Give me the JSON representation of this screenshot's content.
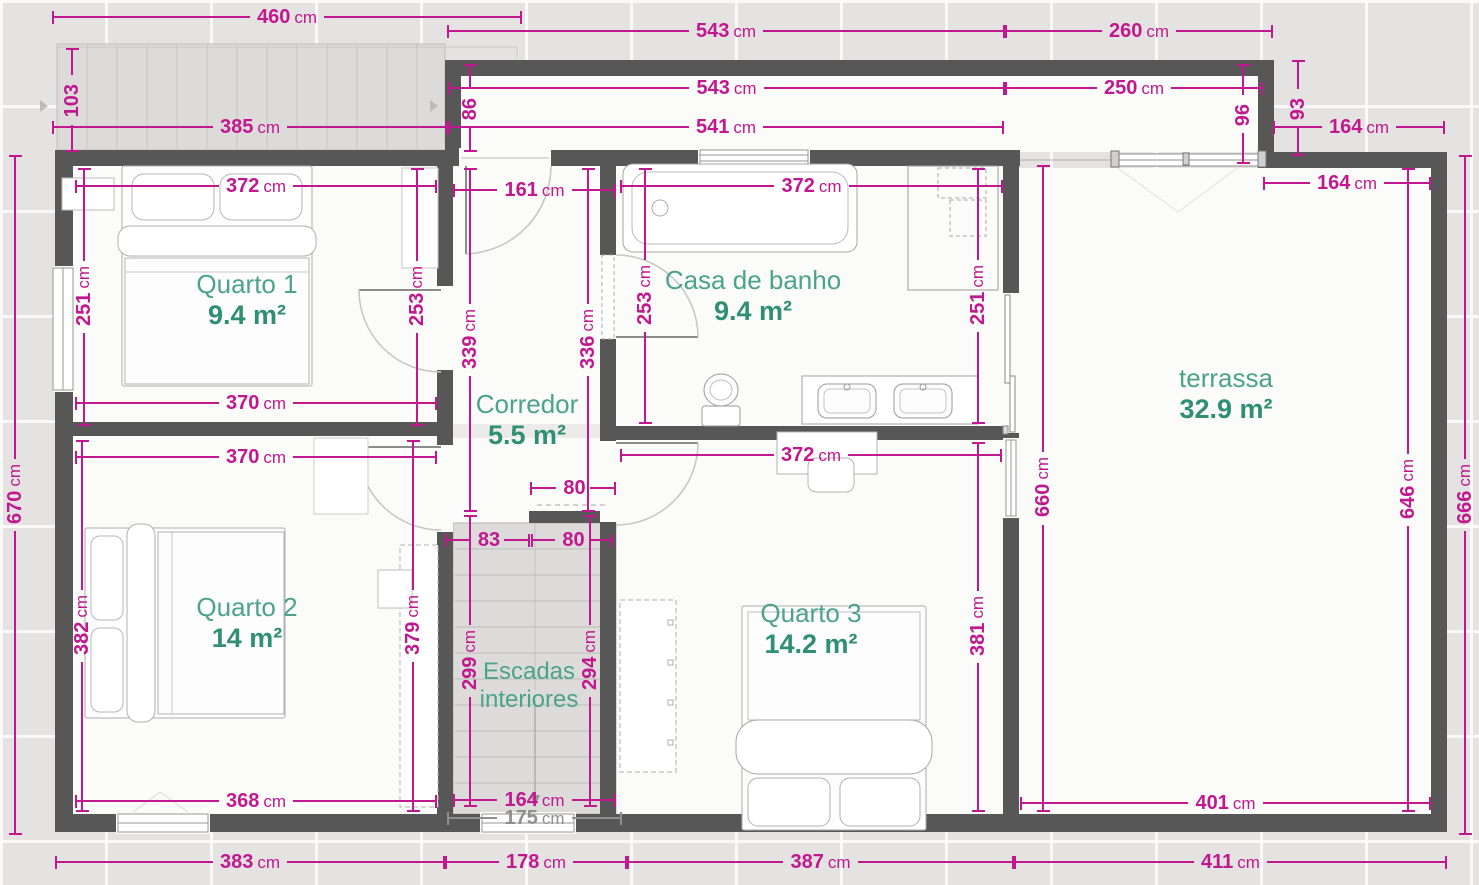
{
  "plan_type": "floor-plan",
  "language": "Portuguese",
  "colors": {
    "dimension": "#c2188f",
    "dimension_gray": "#8f8f8f",
    "room_label": "#4ba38a",
    "room_area": "#2f8f72",
    "wall": "#575757",
    "background": "#e4e3e2"
  },
  "rooms": [
    {
      "name": "Quarto 1",
      "area": "9.4 m²"
    },
    {
      "name": "Casa de banho",
      "area": "9.4 m²"
    },
    {
      "name": "Corredor",
      "area": "5.5 m²"
    },
    {
      "name": "Quarto 2",
      "area": "14 m²"
    },
    {
      "name": "Quarto 3",
      "area": "14.2 m²"
    },
    {
      "name": "Escadas",
      "name2": "interiores",
      "area": ""
    },
    {
      "name": "terrassa",
      "area": "32.9 m²"
    }
  ],
  "dims": [
    {
      "v": "460",
      "u": "cm"
    },
    {
      "v": "543",
      "u": "cm"
    },
    {
      "v": "260",
      "u": "cm"
    },
    {
      "v": "543",
      "u": "cm"
    },
    {
      "v": "250",
      "u": "cm"
    },
    {
      "v": "385",
      "u": "cm"
    },
    {
      "v": "541",
      "u": "cm"
    },
    {
      "v": "164",
      "u": "cm"
    },
    {
      "v": "164",
      "u": "cm"
    },
    {
      "v": "372",
      "u": "cm"
    },
    {
      "v": "161",
      "u": "cm"
    },
    {
      "v": "372",
      "u": "cm"
    },
    {
      "v": "370",
      "u": "cm"
    },
    {
      "v": "370",
      "u": "cm"
    },
    {
      "v": "372",
      "u": "cm"
    },
    {
      "v": "80",
      "u": ""
    },
    {
      "v": "83",
      "u": ""
    },
    {
      "v": "80",
      "u": ""
    },
    {
      "v": "368",
      "u": "cm"
    },
    {
      "v": "164",
      "u": "cm"
    },
    {
      "v": "175",
      "u": "cm"
    },
    {
      "v": "401",
      "u": "cm"
    },
    {
      "v": "383",
      "u": "cm"
    },
    {
      "v": "178",
      "u": "cm"
    },
    {
      "v": "387",
      "u": "cm"
    },
    {
      "v": "411",
      "u": "cm"
    },
    {
      "v": "103",
      "u": ""
    },
    {
      "v": "86",
      "u": ""
    },
    {
      "v": "96",
      "u": ""
    },
    {
      "v": "93",
      "u": ""
    },
    {
      "v": "670",
      "u": "cm"
    },
    {
      "v": "251",
      "u": "cm"
    },
    {
      "v": "253",
      "u": "cm"
    },
    {
      "v": "339",
      "u": "cm"
    },
    {
      "v": "336",
      "u": "cm"
    },
    {
      "v": "253",
      "u": "cm"
    },
    {
      "v": "251",
      "u": "cm"
    },
    {
      "v": "382",
      "u": "cm"
    },
    {
      "v": "379",
      "u": "cm"
    },
    {
      "v": "299",
      "u": "cm"
    },
    {
      "v": "294",
      "u": "cm"
    },
    {
      "v": "381",
      "u": "cm"
    },
    {
      "v": "660",
      "u": "cm"
    },
    {
      "v": "646",
      "u": "cm"
    },
    {
      "v": "666",
      "u": "cm"
    }
  ]
}
